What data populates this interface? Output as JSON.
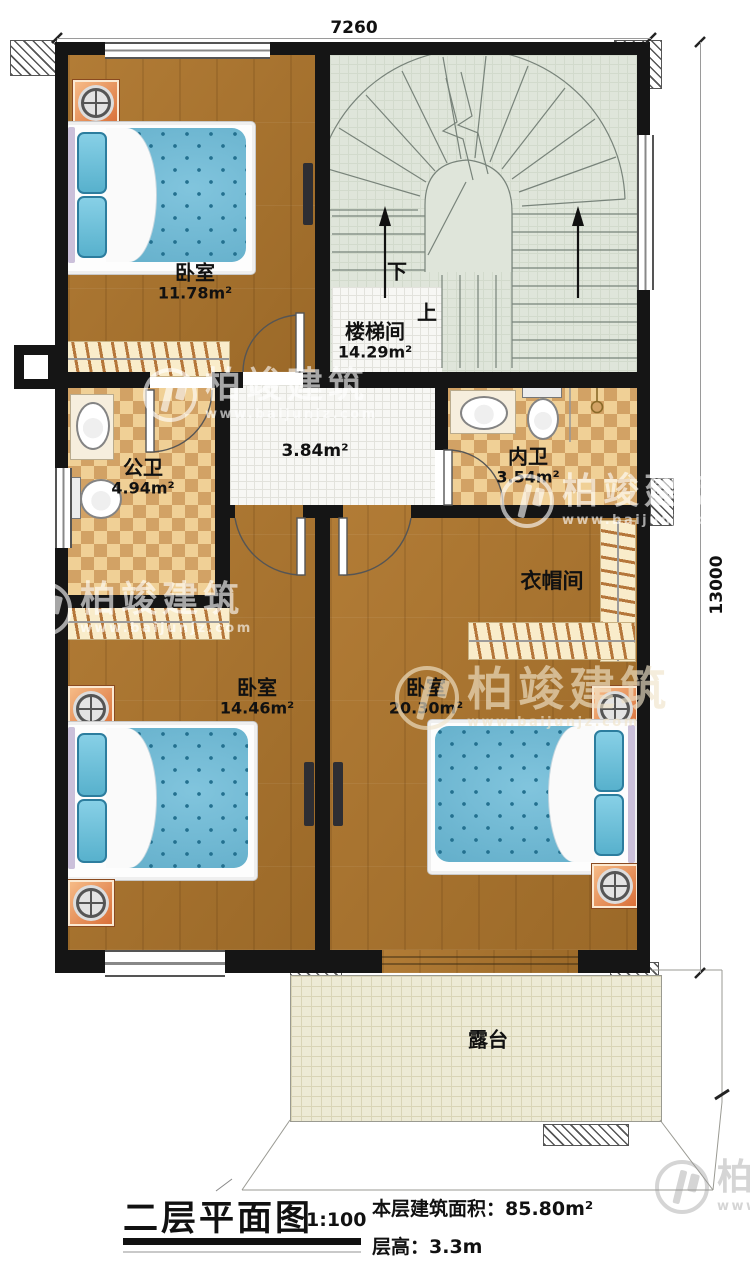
{
  "plan": {
    "title": "二层平面图",
    "scale": "1:100",
    "area_label": "本层建筑面积：",
    "area_value": "85.80m²",
    "height_label": "层高：",
    "height_value": "3.3m"
  },
  "dimensions": {
    "top": "7260",
    "right": "13000"
  },
  "rooms": {
    "bedroom_tl": {
      "name": "卧室",
      "area": "11.78m²"
    },
    "stairwell": {
      "name": "楼梯间",
      "area": "14.29m²",
      "down": "下",
      "up": "上"
    },
    "hallway": {
      "area": "3.84m²"
    },
    "public_bath": {
      "name": "公卫",
      "area": "4.94m²"
    },
    "ensuite_bath": {
      "name": "内卫",
      "area": "3.54m²"
    },
    "cloakroom": {
      "name": "衣帽间"
    },
    "bedroom_bl": {
      "name": "卧室",
      "area": "14.46m²"
    },
    "bedroom_br": {
      "name": "卧室",
      "area": "20.30m²"
    },
    "terrace": {
      "name": "露台"
    }
  },
  "watermark": {
    "brand": "柏竣建筑",
    "site": "www.baijunjz.com"
  },
  "colors": {
    "wall": "#151515",
    "wood": "#a8742f",
    "tile_light": "#f0d096",
    "tile_dark": "#d2a265",
    "stair_floor": "#dfe5da",
    "mattress": "#57b1d2",
    "nightstand": "#e0813f",
    "terrace": "#edead5"
  }
}
